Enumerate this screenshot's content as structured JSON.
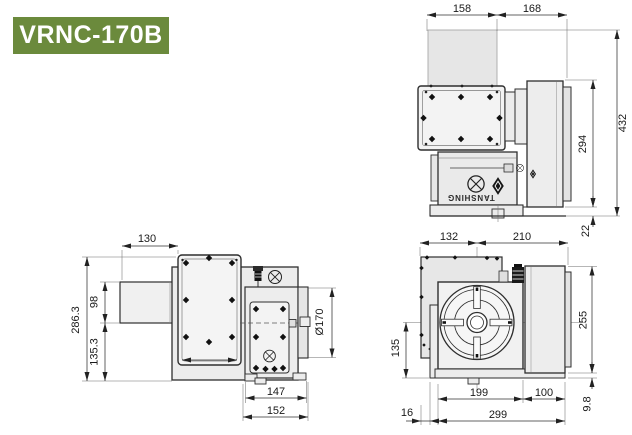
{
  "header": {
    "model_badge": "VRNC-170B",
    "badge_bg": "#6b8a3c",
    "badge_text_color": "#ffffff"
  },
  "brand": {
    "logo_text": "TANSHING"
  },
  "drawing": {
    "type": "technical-dimension-drawing",
    "unit": "mm",
    "line_color": "#2e2e2e",
    "fill_light": "#ececec"
  },
  "views": {
    "side": {
      "label": "side elevation view",
      "dims": {
        "table_width": "158",
        "motor_offset": "168",
        "overall_height": "432",
        "body_height": "294",
        "base_height": "22"
      }
    },
    "plan": {
      "label": "plan (top) view",
      "dims": {
        "motor_length": "130",
        "overall_depth": "286.3",
        "motor_width": "98",
        "front_depth": "135.3",
        "faceplate_diameter": "Ø170",
        "housing_width": "147",
        "housing_overall_width": "152"
      }
    },
    "front": {
      "label": "front view",
      "dims": {
        "center_to_left": "132",
        "center_to_right": "210",
        "body_height": "255",
        "center_height": "135",
        "plate_width": "199",
        "motor_extension": "100",
        "flange_width": "16",
        "overall_width": "299",
        "base_height": "9.8"
      }
    }
  }
}
